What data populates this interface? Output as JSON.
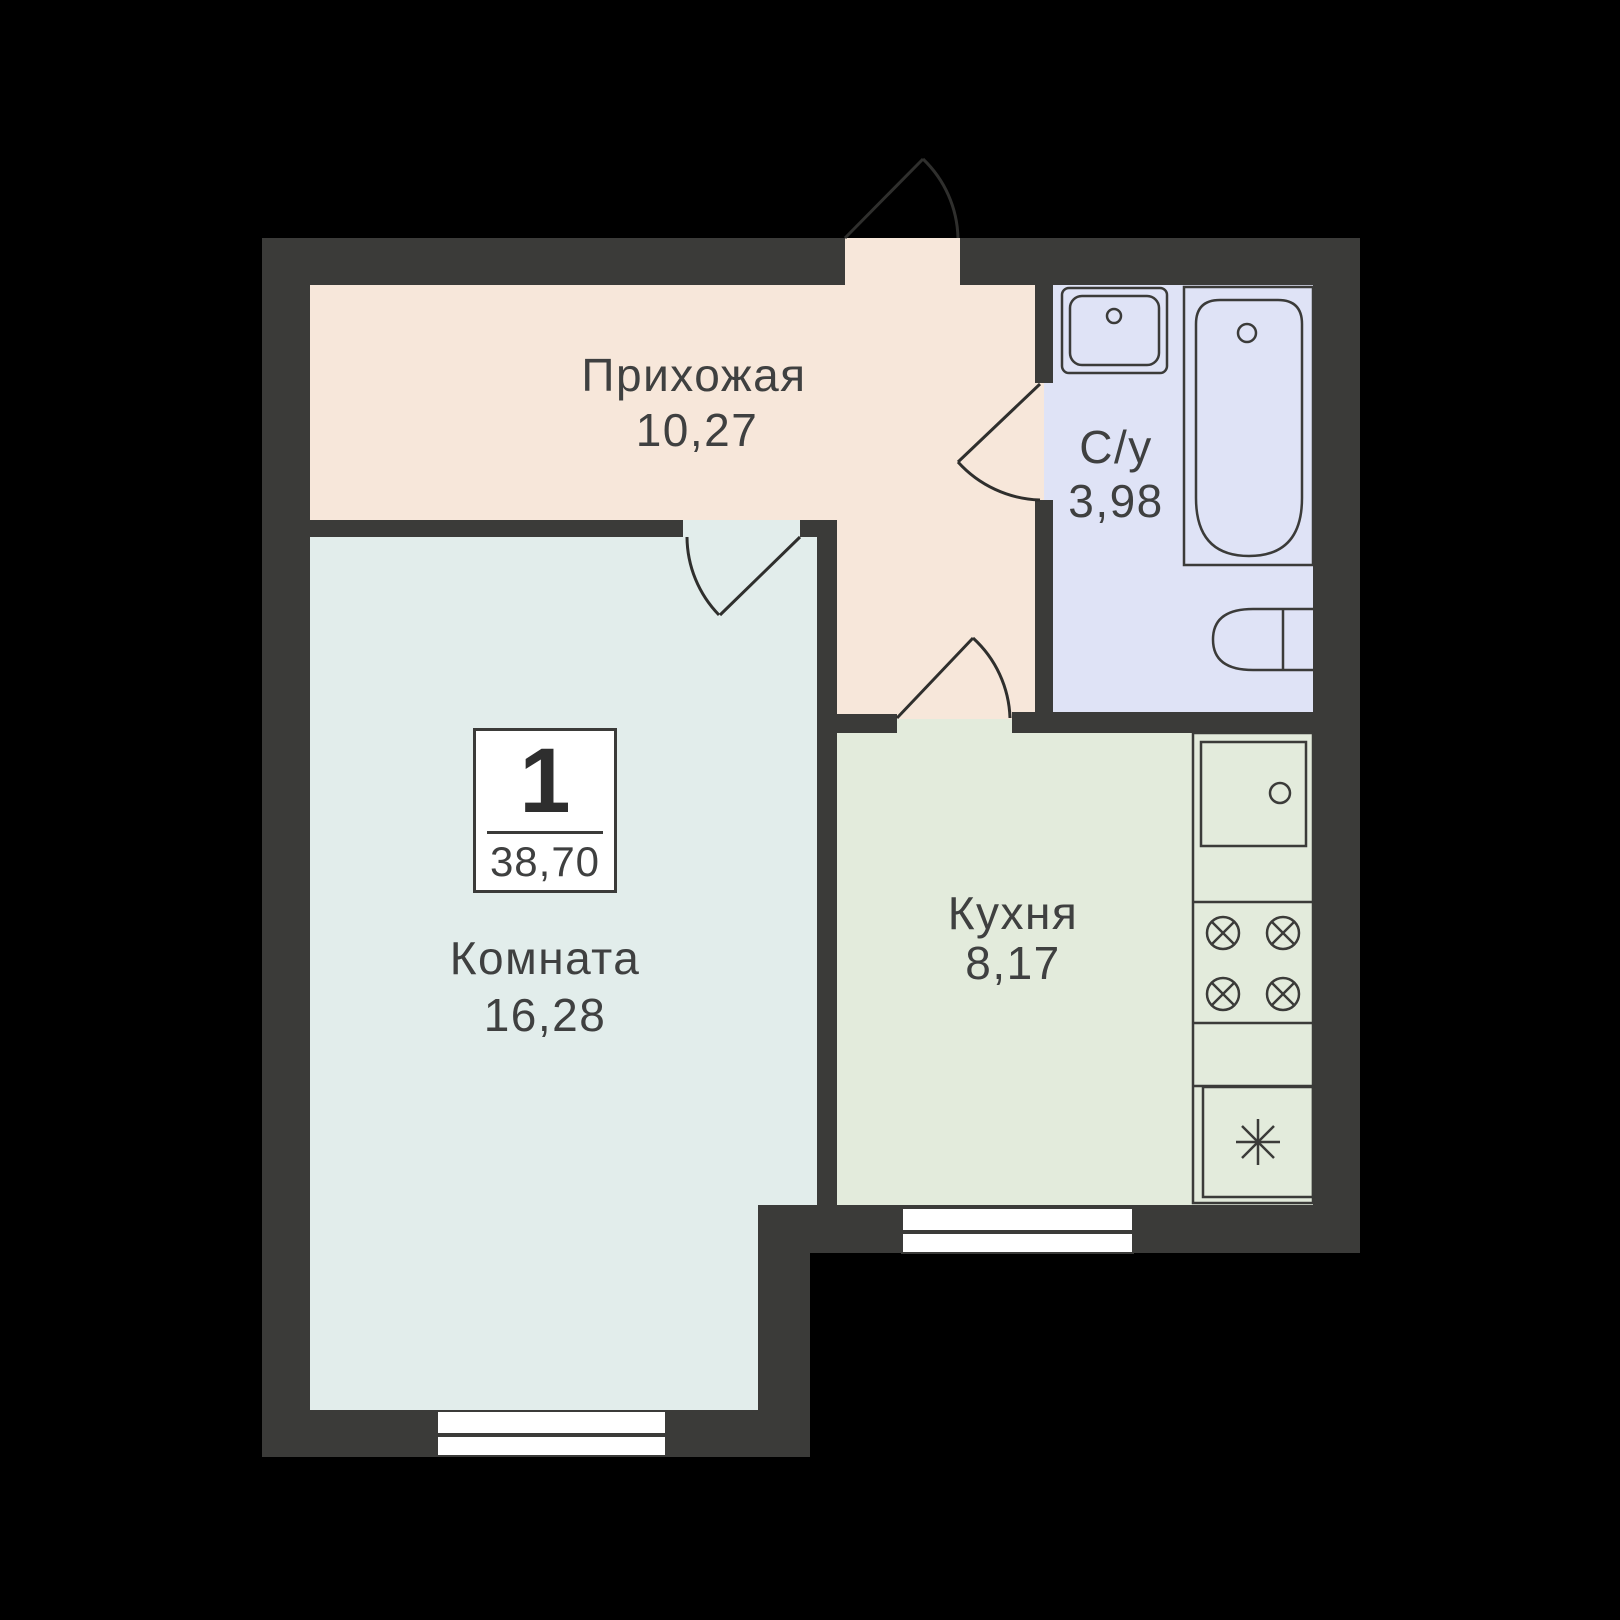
{
  "unit": {
    "number": "1",
    "total_area": "38,70"
  },
  "rooms": {
    "hallway": {
      "label": "Прихожая",
      "area": "10,27"
    },
    "bathroom": {
      "label": "С/у",
      "area": "3,98"
    },
    "living": {
      "label": "Комната",
      "area": "16,28"
    },
    "kitchen": {
      "label": "Кухня",
      "area": "8,17"
    }
  },
  "colors": {
    "background": "#000000",
    "walls": "#3b3b39",
    "hallway_floor": "#f7e7da",
    "living_floor": "#e2edeb",
    "bathroom_floor": "#dfe3f6",
    "kitchen_floor": "#e3ebdc",
    "window": "#ffffff",
    "text": "#3f4040"
  },
  "fixtures": {
    "bathroom": [
      "sink",
      "bathtub",
      "toilet"
    ],
    "kitchen": [
      "sink",
      "stove-4-burners",
      "fridge"
    ]
  }
}
